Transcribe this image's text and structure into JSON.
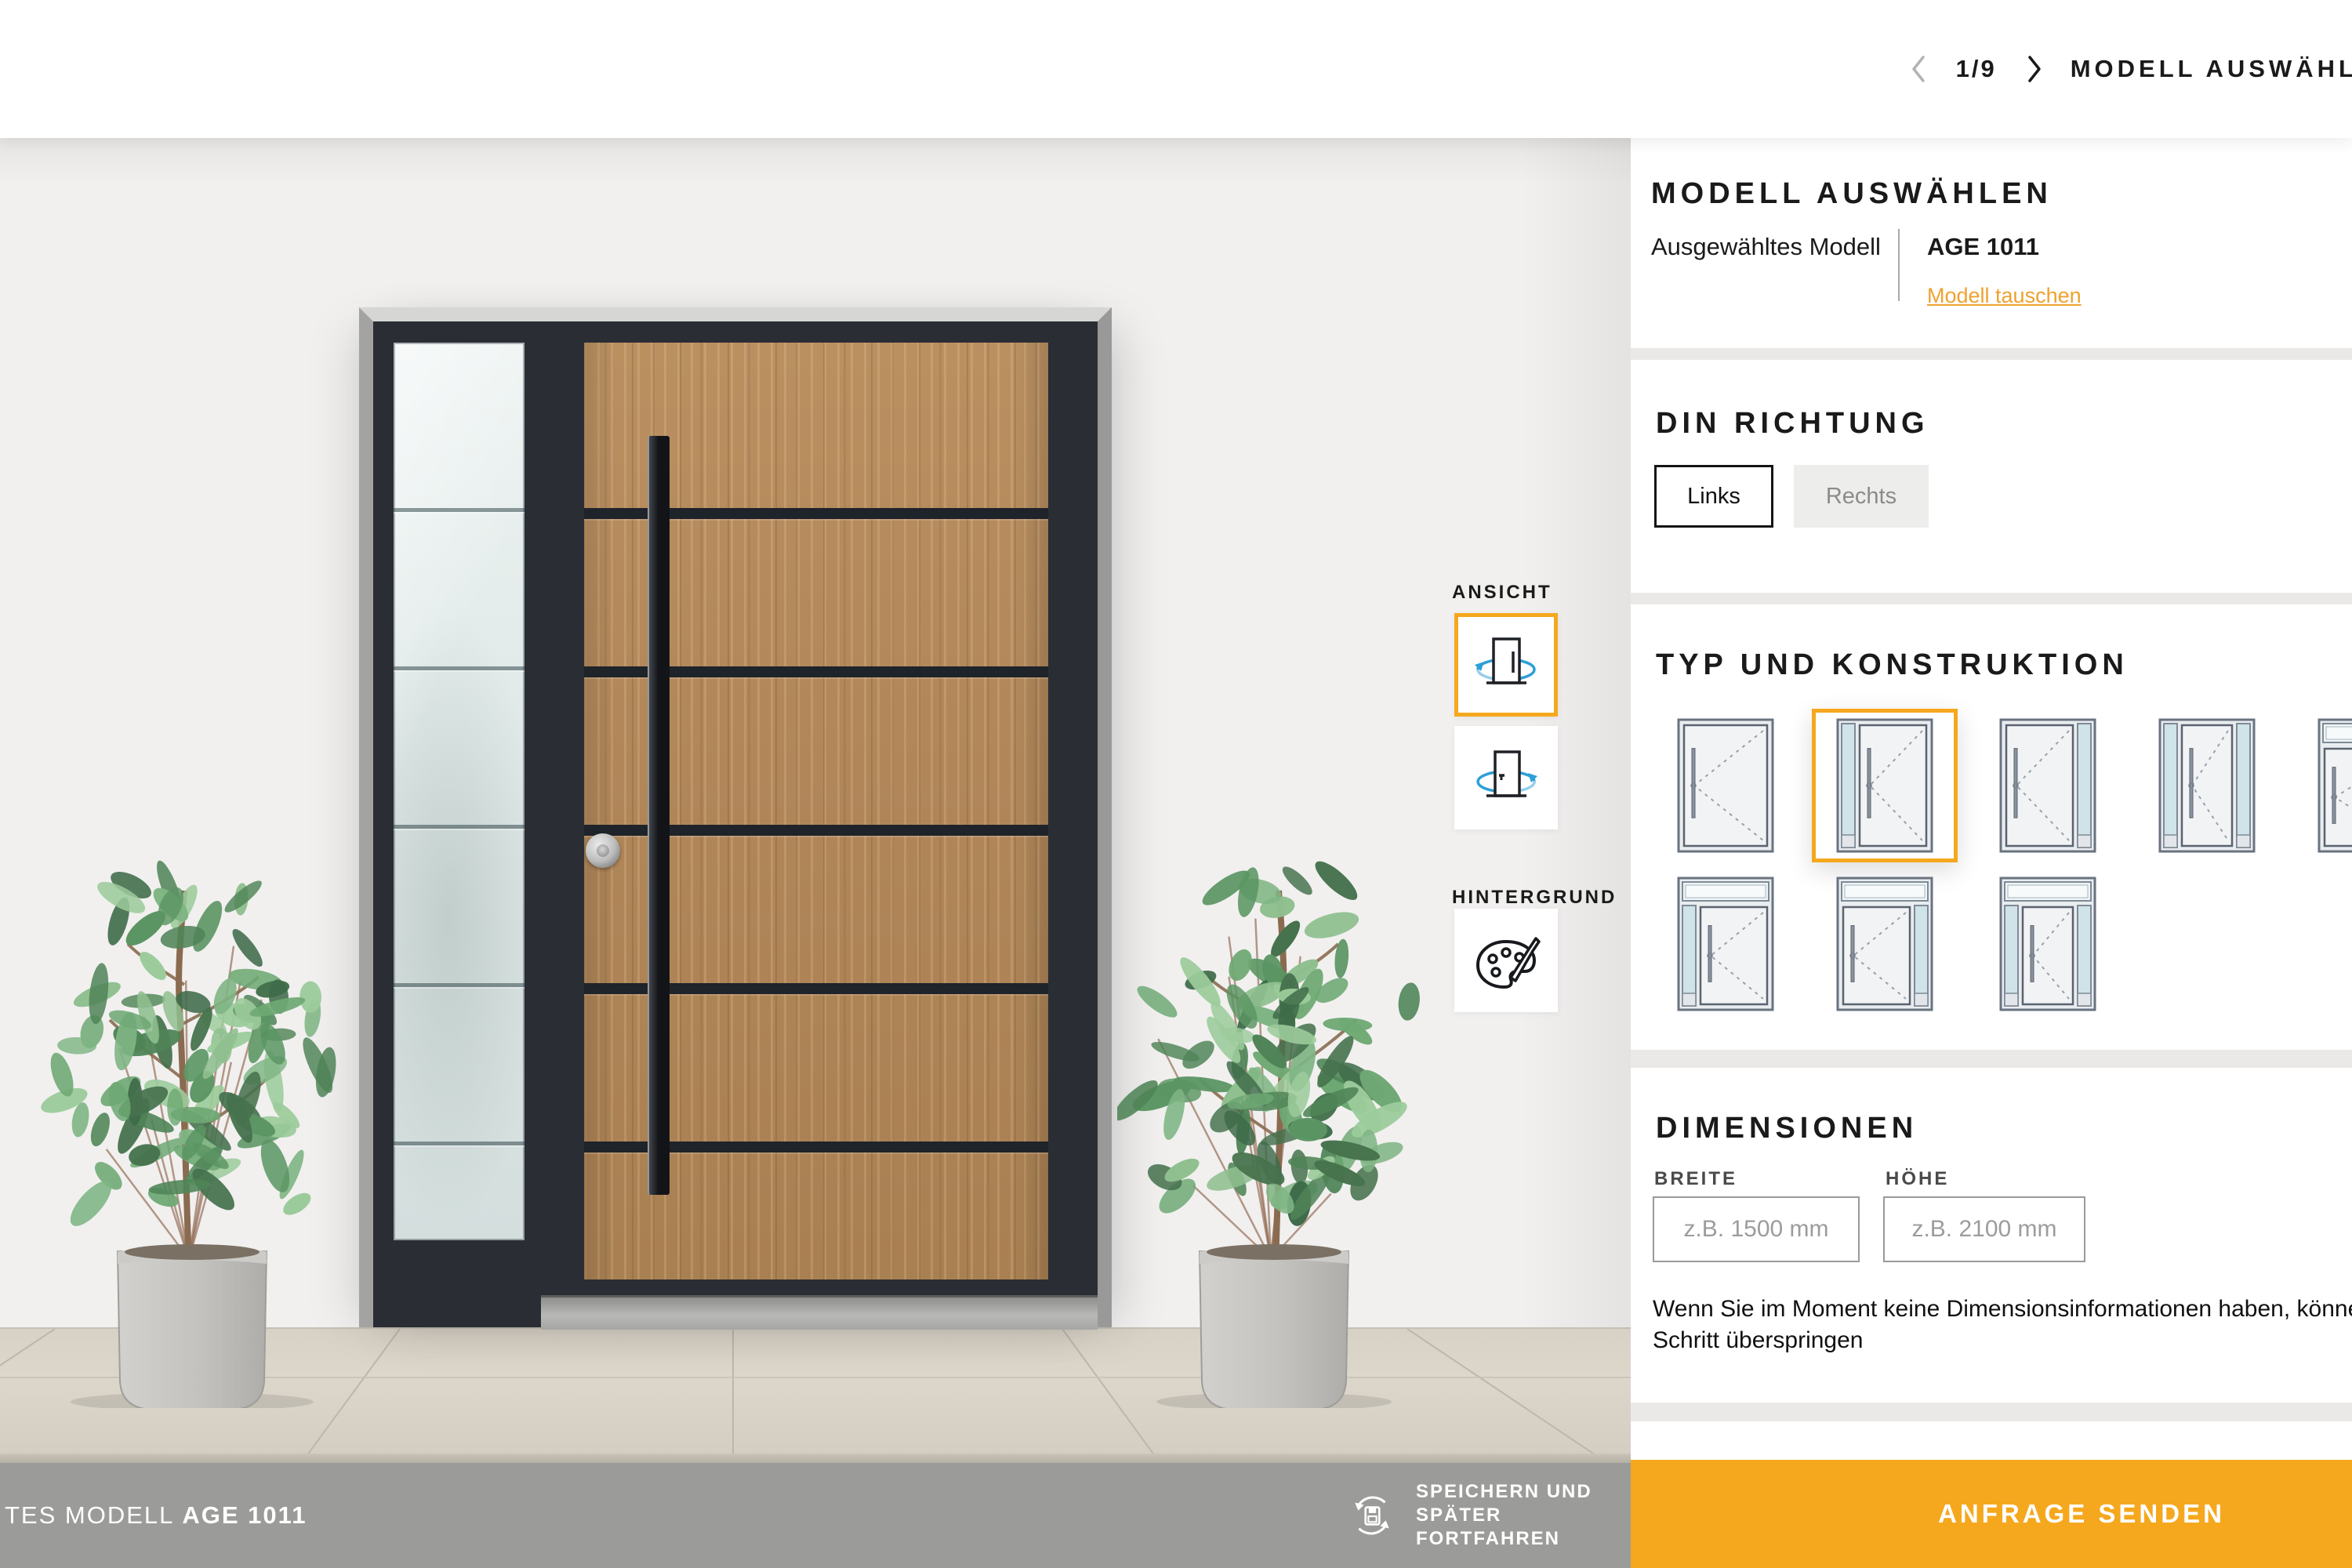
{
  "colors": {
    "accent": "#F5A81E",
    "selected_outline": "#F2A42B",
    "door_frame": "#2A2D34",
    "wood": "#B3895B",
    "footer_bar": "#9B9B99",
    "link_orange": "#EFA22F"
  },
  "header": {
    "nav": {
      "page": "1/9",
      "title": "MODELL AUSWÄHLEN"
    }
  },
  "panel": {
    "model_section": {
      "title": "MODELL AUSWÄHLEN",
      "selected_label": "Ausgewähltes Modell",
      "model_name": "AGE 1011",
      "change_link": "Modell tauschen"
    },
    "din_section": {
      "title": "DIN RICHTUNG",
      "options": [
        {
          "label": "Links",
          "selected": true
        },
        {
          "label": "Rechts",
          "selected": false
        }
      ]
    },
    "type_section": {
      "title": "TYP UND KONSTRUKTION",
      "door_types": [
        {
          "name": "single-door",
          "transom": false,
          "glass_left": false,
          "glass_right": false,
          "selected": false
        },
        {
          "name": "door-sidelight-left",
          "transom": false,
          "glass_left": true,
          "glass_right": false,
          "selected": true
        },
        {
          "name": "door-sidelight-right",
          "transom": false,
          "glass_left": false,
          "glass_right": true,
          "selected": false
        },
        {
          "name": "door-sidelight-both",
          "transom": false,
          "glass_left": true,
          "glass_right": true,
          "selected": false
        },
        {
          "name": "door-transom",
          "transom": true,
          "glass_left": false,
          "glass_right": false,
          "selected": false
        },
        {
          "name": "door-transom-sidelight-left",
          "transom": true,
          "glass_left": true,
          "glass_right": false,
          "selected": false
        },
        {
          "name": "door-transom-sidelight-right",
          "transom": true,
          "glass_left": false,
          "glass_right": true,
          "selected": false
        },
        {
          "name": "door-transom-sidelight-both",
          "transom": true,
          "glass_left": true,
          "glass_right": true,
          "selected": false
        }
      ]
    },
    "dimensions_section": {
      "title": "DIMENSIONEN",
      "width_label": "BREITE",
      "width_placeholder": "z.B. 1500 mm",
      "width_value": "",
      "height_label": "HÖHE",
      "height_placeholder": "z.B. 2100 mm",
      "height_value": "",
      "note_line1": "Wenn Sie im Moment keine Dimensionsinformationen haben, können",
      "note_line2": "Schritt überspringen"
    }
  },
  "viewer": {
    "ansicht_label": "ANSICHT",
    "hintergrund_label": "HINTERGRUND",
    "selected_view": "outside"
  },
  "footer": {
    "model_prefix": "TES MODELL",
    "model_name": "AGE 1011",
    "save_lines": [
      "SPEICHERN UND",
      "SPÄTER",
      "FORTFAHREN"
    ],
    "submit_label": "ANFRAGE SENDEN"
  }
}
